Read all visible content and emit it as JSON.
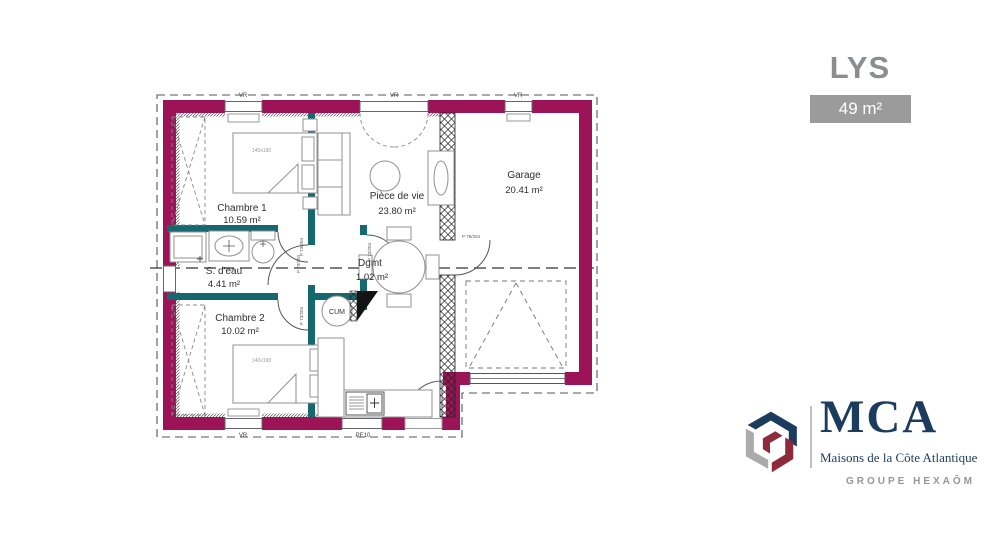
{
  "header": {
    "title": "LYS",
    "area_badge": "49 m²"
  },
  "rooms": [
    {
      "id": "chambre1",
      "name": "Chambre 1",
      "area": "10.59 m²"
    },
    {
      "id": "piece_de_vie",
      "name": "Pièce de vie",
      "area": "23.80 m²"
    },
    {
      "id": "garage",
      "name": "Garage",
      "area": "20.41 m²"
    },
    {
      "id": "s_eau",
      "name": "S. d'eau",
      "area": "4.41 m²"
    },
    {
      "id": "dgmt",
      "name": "Dgmt",
      "area": "1.02 m²"
    },
    {
      "id": "chambre2",
      "name": "Chambre 2",
      "area": "10.02 m²"
    }
  ],
  "annotations": {
    "shutter_label": "VR",
    "entry_label": "PE10",
    "door_label": "P 73/204",
    "garage_door_label": "P 75/204",
    "water_heater": "CUM",
    "bed_size": "140x190"
  },
  "logo": {
    "name": "MCA",
    "subtitle": "Maisons de la Côte Atlantique",
    "group": "GROUPE HEXAÔM"
  },
  "colors": {
    "exterior_wall": "#9c1457",
    "interior_wall": "#15696e",
    "brand_navy": "#1c3c5e",
    "logo_maroon": "#8f2a3d",
    "logo_gray": "#ababab",
    "badge_gray": "#9b9b9b"
  }
}
